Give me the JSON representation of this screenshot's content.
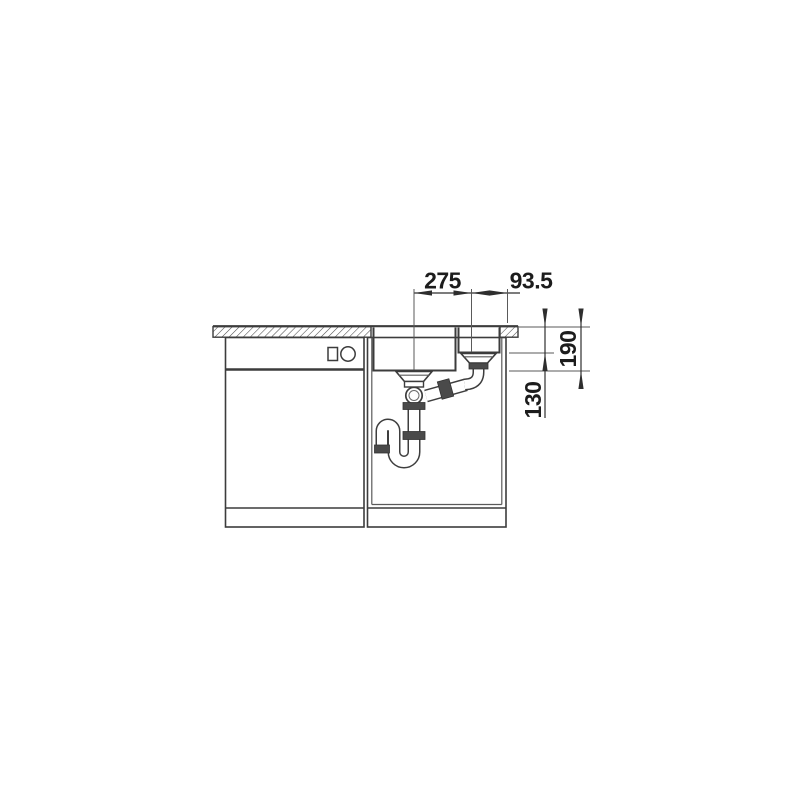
{
  "page": {
    "background": "#ffffff",
    "description": "Technical side-elevation drawing of an undermount kitchen sink with drain plumbing and adjacent dishwasher cabinet"
  },
  "diagram": {
    "labels": {
      "drain_spacing": "275",
      "drain_to_edge": "93.5",
      "main_bowl_depth": "190",
      "small_bowl_depth": "130"
    },
    "colors": {
      "outline": "#3c3c3c",
      "thin_line": "#5a5a5a",
      "dimension": "#2e2e2e",
      "fitting_fill": "#4a4a4a",
      "text": "#1c1c1c",
      "background": "#ffffff"
    }
  }
}
